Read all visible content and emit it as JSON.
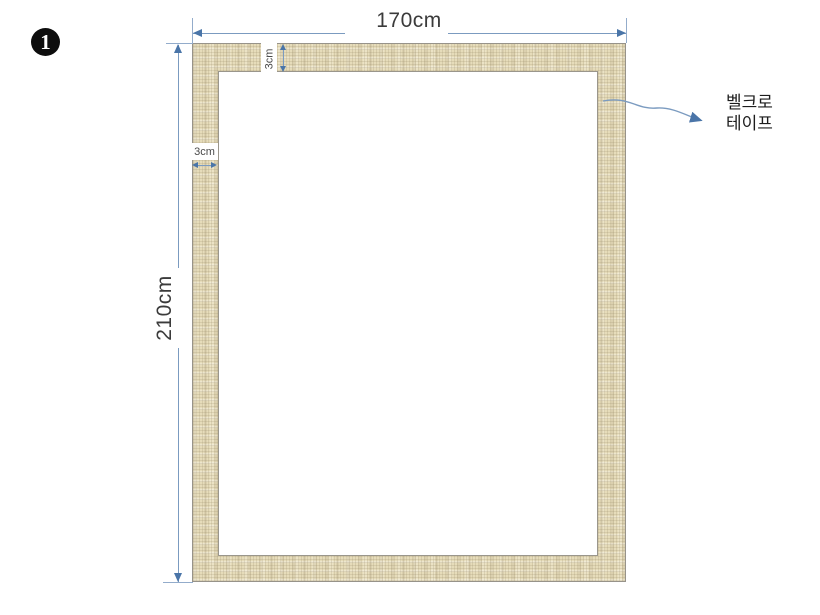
{
  "slide": {
    "step_badge": "1",
    "dimensions": {
      "width_label": "170cm",
      "height_label": "210cm",
      "top_border_label": "3cm",
      "left_border_label": "3cm"
    },
    "callout": {
      "line1": "벨크로",
      "line2": "테이프"
    },
    "colors": {
      "dimension_line": "#7b9bc0",
      "extension_line": "#93accb",
      "arrowhead": "#4a75a8",
      "frame_texture_base": "#e6dcba",
      "frame_outline": "#97938a",
      "opening_fill": "#ffffff",
      "label_text": "#3b3b3b",
      "badge_fill": "#0d0d0d"
    }
  }
}
